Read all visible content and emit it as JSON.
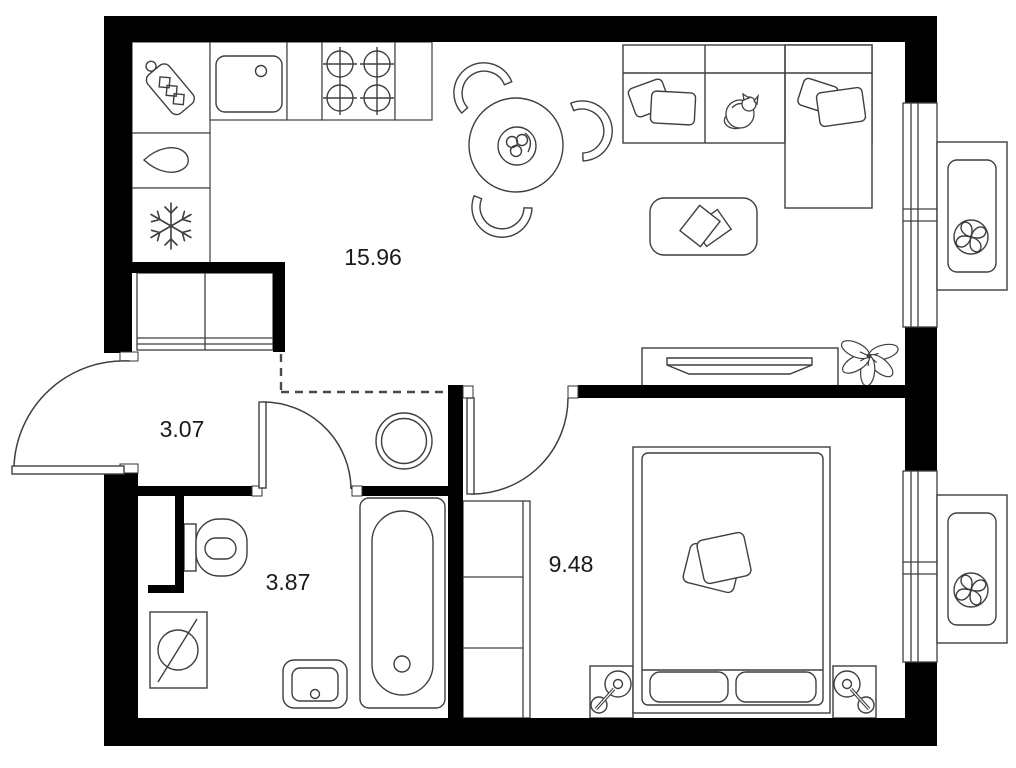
{
  "rooms": {
    "living_kitchen": {
      "area_label": "15.96"
    },
    "hallway": {
      "area_label": "3.07"
    },
    "bathroom": {
      "area_label": "3.87"
    },
    "bedroom": {
      "area_label": "9.48"
    }
  },
  "colors": {
    "wall": "#000000",
    "furniture_line": "#3f3f3f",
    "background": "#ffffff",
    "label_text": "#1a1a1a"
  },
  "icons": {
    "kitchen": [
      "cutting-board-icon",
      "sink-icon",
      "stove-burners-icon",
      "water-drop-icon",
      "snowflake-fridge-icon"
    ],
    "living": [
      "dining-table-icon",
      "chair-icon",
      "sofa-icon",
      "cat-icon",
      "coffee-table-icon",
      "tv-icon",
      "plant-icon"
    ],
    "bathroom": [
      "toilet-icon",
      "washing-machine-icon",
      "washbasin-icon",
      "bathtub-icon",
      "laundry-basket-icon"
    ],
    "bedroom": [
      "double-bed-icon",
      "wardrobe-icon",
      "nightstand-lamp-icon"
    ],
    "exterior": [
      "window-icon",
      "ac-fan-icon",
      "door-swing-icon"
    ]
  }
}
